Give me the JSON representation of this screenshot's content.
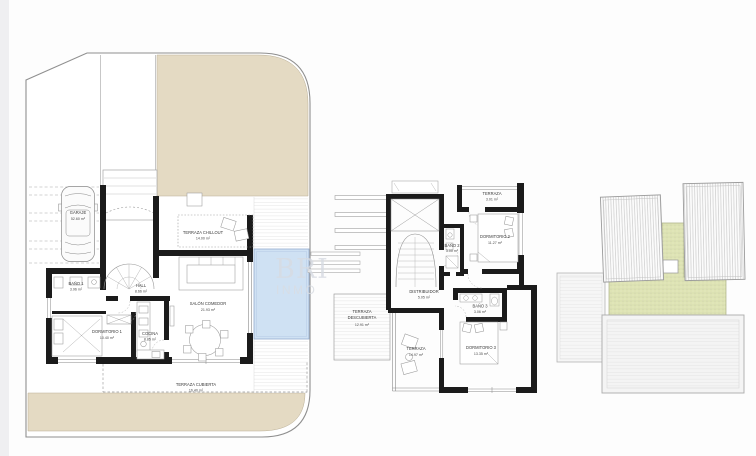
{
  "watermark": {
    "line1": "BRI",
    "line2": "INMO"
  },
  "colors": {
    "plot_beige": "#e4dac3",
    "roof_green": "#e0e5b8",
    "pool_blue": "#cfe1f3",
    "wall_black": "#1b1b1b",
    "line_gray": "#9a9a9a"
  },
  "ground": {
    "garaje": {
      "name": "GARAJE",
      "area": "52.60 m²"
    },
    "bano1": {
      "name": "BAÑO 1",
      "area": "3.96 m²"
    },
    "hall": {
      "name": "HALL",
      "area": "8.66 m²"
    },
    "dormitorio1": {
      "name": "DORMITORIO 1",
      "area": "10.40 m²"
    },
    "cocina": {
      "name": "COCINA",
      "area": "8.85 m²"
    },
    "salon": {
      "name": "SALÓN COMEDOR",
      "area": "21.93 m²"
    },
    "chillout": {
      "name": "TERRAZA CHILLOUT",
      "area": "14.00 m²"
    },
    "terraza_cubierta": {
      "name": "TERRAZA CUBIERTA",
      "area": "16.40 m²"
    }
  },
  "first": {
    "terraza_dorm2": {
      "name": "TERRAZA",
      "area": "3.01 m²"
    },
    "dormitorio2": {
      "name": "DORMITORIO 2",
      "area": "11.27 m²"
    },
    "bano2": {
      "name": "BAÑO 2",
      "area": "3.00 m²"
    },
    "distribuidor": {
      "name": "DISTRIBUIDOR",
      "area": "5.05 m²"
    },
    "bano3": {
      "name": "BAÑO 3",
      "area": "3.06 m²"
    },
    "dormitorio3": {
      "name": "DORMITORIO 3",
      "area": "13.35 m²"
    },
    "terraza": {
      "name": "TERRAZA",
      "area": "14.97 m²"
    },
    "terraza_descubierta": {
      "name_line1": "TERRAZA",
      "name_line2": "DESCUBIERTA",
      "area": "12.91 m²"
    }
  }
}
